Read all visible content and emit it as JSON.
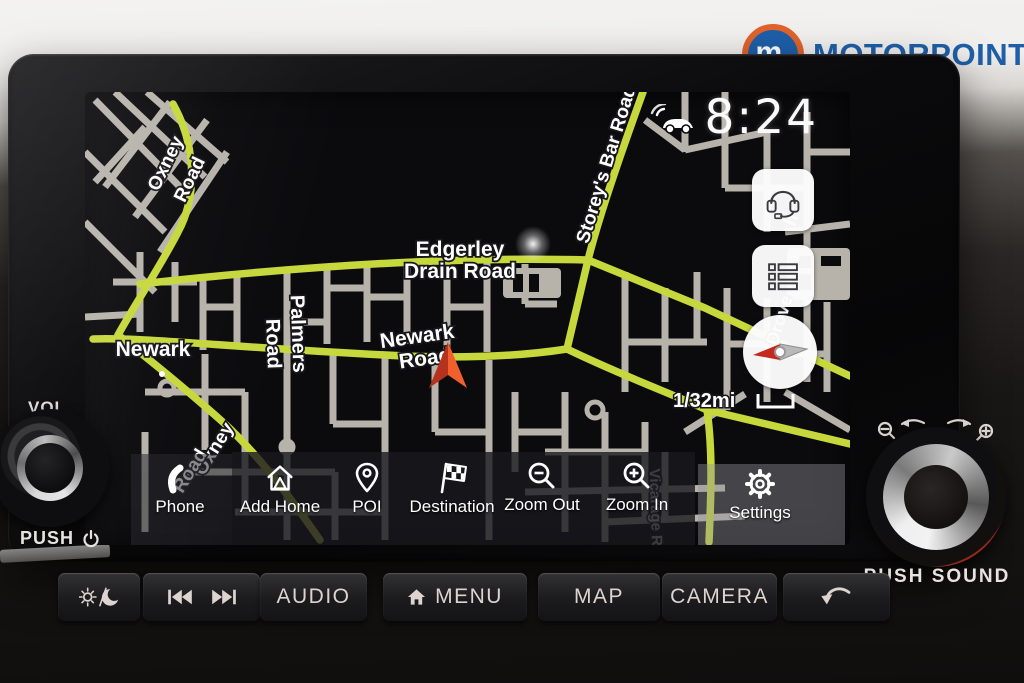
{
  "branding": {
    "logo_text": "MOTORPOINT",
    "logo_monogram": "m.",
    "brand_blue": "#1e5fa8",
    "brand_orange": "#e0632b"
  },
  "status": {
    "time": "8:24"
  },
  "map": {
    "scale_label": "1/32mi",
    "labels": {
      "oxney_top_1": "Oxney",
      "oxney_top_2": "Road",
      "storeys_bar": "Storey's Bar Road",
      "edgerley_1": "Edgerley",
      "edgerley_2": "Drain Road",
      "palmers_1": "Palmers",
      "palmers_2": "Road",
      "newark_road_1": "Newark",
      "newark_road_2": "Road",
      "newark_town": "Newark",
      "oxney_bottom_1": "Oxney",
      "oxney_bottom_2": "Road",
      "fragment_top": "h",
      "fragment_bottom": "Drove",
      "vicarage_fragment": "Vicarage Rd"
    },
    "colors": {
      "background": "#0b0b0e",
      "street": "#b7b3ab",
      "main_road": "#c6d83c",
      "label_text": "#ffffff",
      "position_arrow": "#f15f2c"
    },
    "side_buttons": [
      {
        "icon": "headset-icon"
      },
      {
        "icon": "list-icon"
      },
      {
        "icon": "compass-icon"
      }
    ]
  },
  "toolbar": {
    "items": [
      {
        "label": "Phone",
        "icon": "phone-icon"
      },
      {
        "label": "Add Home",
        "icon": "add-home-icon"
      },
      {
        "label": "POI",
        "icon": "poi-pin-icon"
      },
      {
        "label": "Destination",
        "icon": "destination-flag-icon"
      },
      {
        "label": "Zoom Out",
        "icon": "zoom-out-icon"
      },
      {
        "label": "Zoom In",
        "icon": "zoom-in-icon"
      },
      {
        "label": "Settings",
        "icon": "settings-gear-icon"
      }
    ]
  },
  "hardware": {
    "left_knob": {
      "label_top": "VOL",
      "label_bottom": "PUSH"
    },
    "right_knob": {
      "label_bottom": "PUSH SOUND"
    },
    "buttons": {
      "audio": "AUDIO",
      "menu": "MENU",
      "map": "MAP",
      "camera": "CAMERA"
    }
  }
}
